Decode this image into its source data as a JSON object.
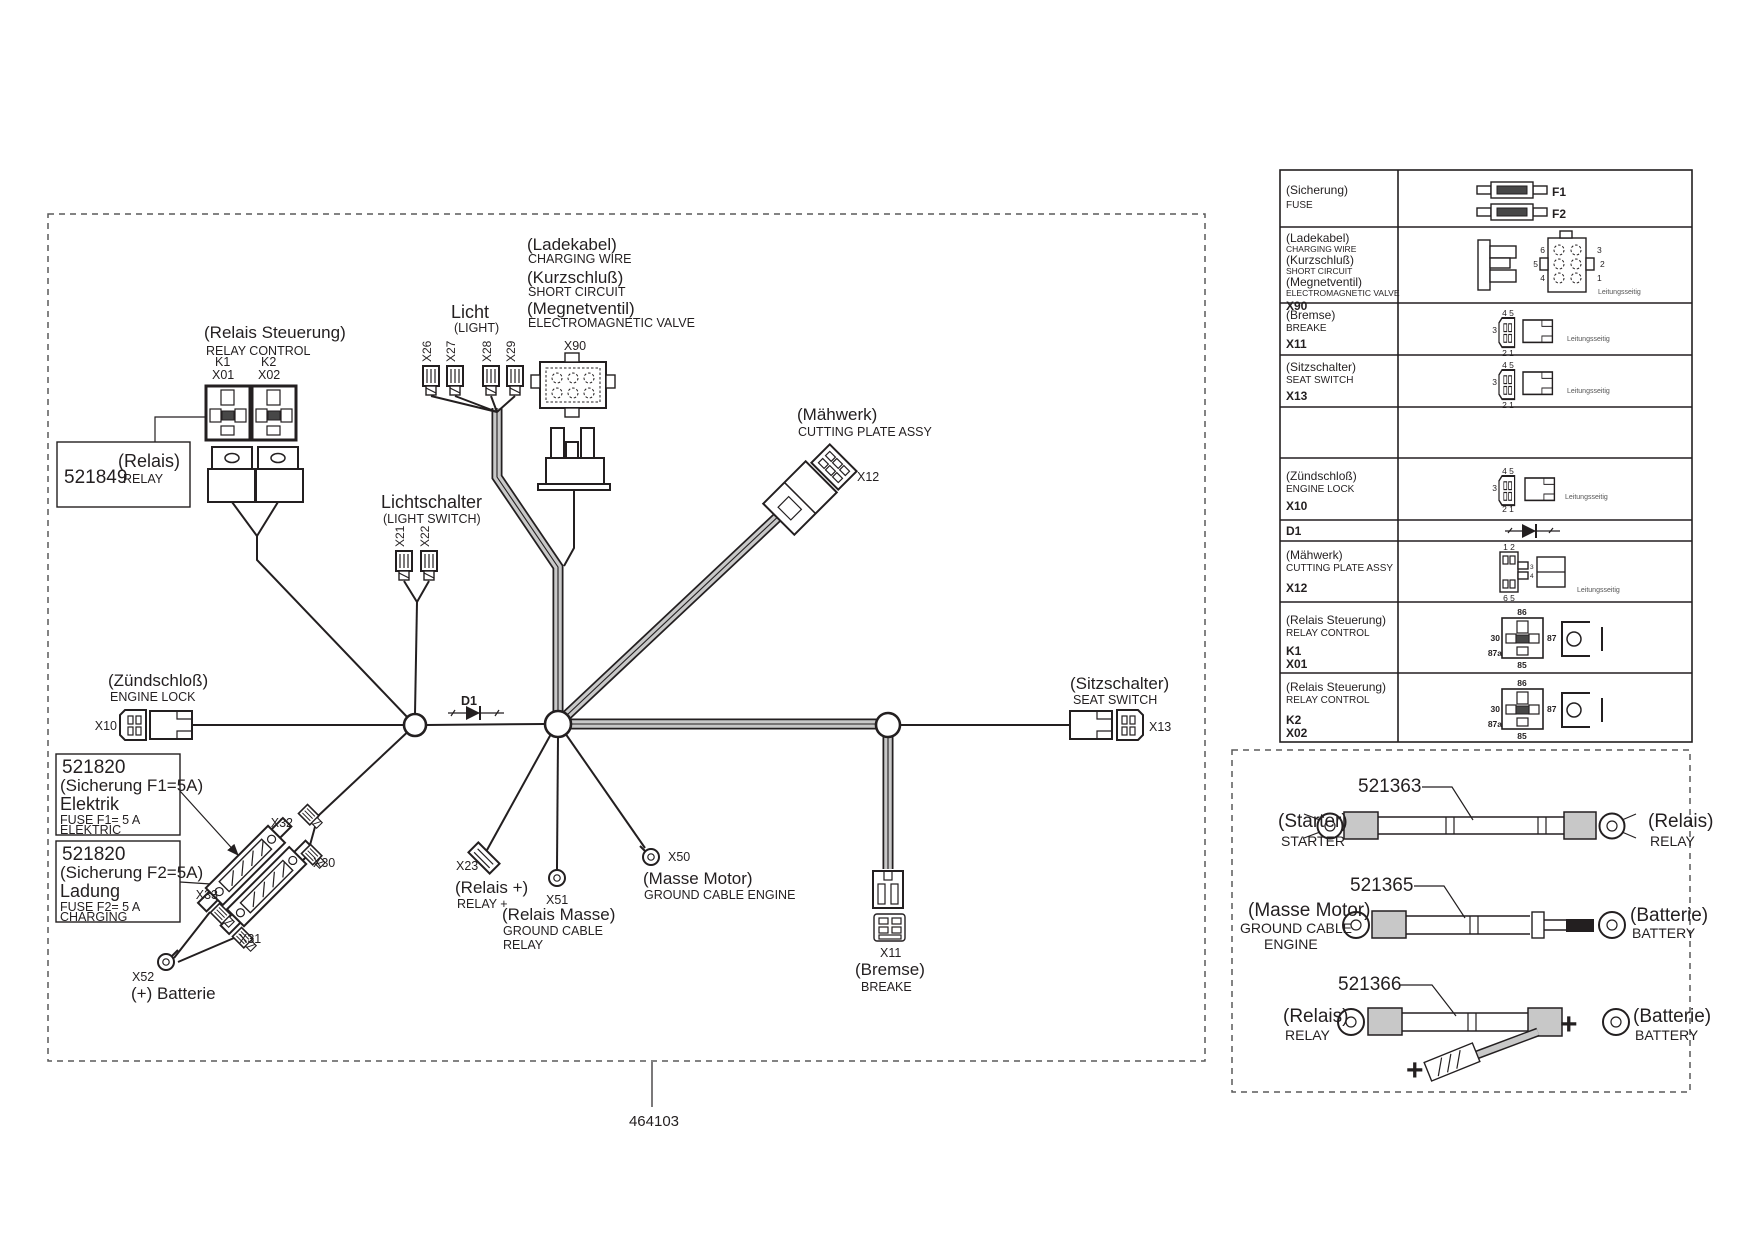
{
  "doc": {
    "part_number": "464103"
  },
  "main": {
    "relay_control": {
      "de": "(Relais Steuerung)",
      "en": "RELAY CONTROL",
      "k1": "K1",
      "k2": "K2",
      "x01": "X01",
      "x02": "X02"
    },
    "relay_part": {
      "number": "521849",
      "de": "(Relais)",
      "en": "RELAY"
    },
    "light": {
      "de": "Licht",
      "en": "(LIGHT)",
      "x26": "X26",
      "x27": "X27",
      "x28": "X28",
      "x29": "X29"
    },
    "charging": {
      "de1": "(Ladekabel)",
      "en1": "CHARGING WIRE",
      "de2": "(Kurzschluß)",
      "en2": "SHORT CIRCUIT",
      "de3": "(Megnetventil)",
      "en3": "ELECTROMAGNETIC VALVE",
      "x90": "X90"
    },
    "light_switch": {
      "de": "Lichtschalter",
      "en": "(LIGHT SWITCH)",
      "x21": "X21",
      "x22": "X22"
    },
    "cutting": {
      "de": "(Mähwerk)",
      "en": "CUTTING PLATE ASSY",
      "x12": "X12"
    },
    "engine_lock": {
      "de": "(Zündschloß)",
      "en": "ENGINE LOCK",
      "x10": "X10"
    },
    "diode": "D1",
    "fuse1": {
      "number": "521820",
      "de": "(Sicherung F1=5A)",
      "name": "Elektrik",
      "en1": "FUSE F1= 5 A",
      "en2": "ELEKTRIC"
    },
    "fuse2": {
      "number": "521820",
      "de": "(Sicherung F2=5A)",
      "name": "Ladung",
      "en1": "FUSE F2= 5 A",
      "en2": "CHARGING"
    },
    "x32": "X32",
    "x30": "X30",
    "x33": "X33",
    "x31": "X31",
    "battery": {
      "x52": "X52",
      "label": "(+) Batterie"
    },
    "relay_plus": {
      "x23": "X23",
      "de": "(Relais +)",
      "en": "RELAY +"
    },
    "relay_ground": {
      "x51": "X51",
      "de": "(Relais Masse)",
      "en1": "GROUND CABLE",
      "en2": "RELAY"
    },
    "engine_ground": {
      "x50": "X50",
      "de": "(Masse Motor)",
      "en": "GROUND CABLE ENGINE"
    },
    "brake": {
      "x11": "X11",
      "de": "(Bremse)",
      "en": "BREAKE"
    },
    "seat": {
      "de": "(Sitzschalter)",
      "en": "SEAT SWITCH",
      "x13": "X13"
    }
  },
  "table": {
    "wire_side": "Leitungsseitig",
    "pins": {
      "p45": "4 5",
      "p3": "3",
      "p21": "2 1",
      "p12": "1 2",
      "p65": "6 5",
      "p6": "6",
      "p5": "5",
      "p4": "4",
      "p2": "2",
      "p1": "1",
      "p86": "86",
      "p30": "30",
      "p87": "87",
      "p87a": "87a",
      "p85": "85",
      "f1": "F1",
      "f2": "F2"
    },
    "rows": [
      {
        "l1": "(Sicherung)",
        "l2": "FUSE"
      },
      {
        "l1": "(Ladekabel)",
        "l2": "CHARGING WIRE",
        "l3": "(Kurzschluß)",
        "l4": "SHORT CIRCUIT",
        "l5": "(Megnetventil)",
        "l6": "ELECTROMAGNETIC VALVE",
        "id": "X90"
      },
      {
        "l1": "(Bremse)",
        "l2": "BREAKE",
        "id": "X11"
      },
      {
        "l1": "(Sitzschalter)",
        "l2": "SEAT SWITCH",
        "id": "X13"
      },
      {},
      {
        "l1": "(Zündschloß)",
        "l2": "ENGINE LOCK",
        "id": "X10"
      },
      {
        "id": "D1"
      },
      {
        "l1": "(Mähwerk)",
        "l2": "CUTTING PLATE ASSY",
        "id": "X12"
      },
      {
        "l1": "(Relais Steuerung)",
        "l2": "RELAY CONTROL",
        "id": "K1",
        "id2": "X01"
      },
      {
        "l1": "(Relais Steuerung)",
        "l2": "RELAY CONTROL",
        "id": "K2",
        "id2": "X02"
      }
    ]
  },
  "cables": {
    "c1": {
      "number": "521363",
      "left_de": "(Starter)",
      "left_en": "STARTER",
      "right_de": "(Relais)",
      "right_en": "RELAY"
    },
    "c2": {
      "number": "521365",
      "left_de": "(Masse Motor)",
      "left_en1": "GROUND CABLE",
      "left_en2": "ENGINE",
      "right_de": "(Batterie)",
      "right_en": "BATTERY"
    },
    "c3": {
      "number": "521366",
      "left_de": "(Relais)",
      "left_en": "RELAY",
      "right_de": "(Batterie)",
      "right_en": "BATTERY",
      "plus": "+"
    }
  }
}
